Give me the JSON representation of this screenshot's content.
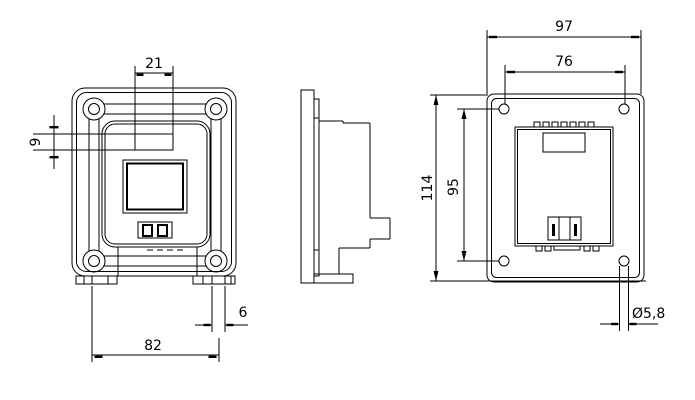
{
  "drawing": {
    "description": "Three-view technical dimension drawing of a flanged panel-mount socket plate",
    "colors": {
      "line": "#000000",
      "background": "#ffffff"
    },
    "dimensions": {
      "front": {
        "window_width": "21",
        "window_height": "9",
        "bottom_span": "82",
        "tab_width": "6"
      },
      "back": {
        "overall_width": "97",
        "hole_spacing_horizontal": "76",
        "overall_height": "114",
        "hole_spacing_vertical": "95",
        "hole_diameter": "Ø5,8"
      }
    }
  }
}
